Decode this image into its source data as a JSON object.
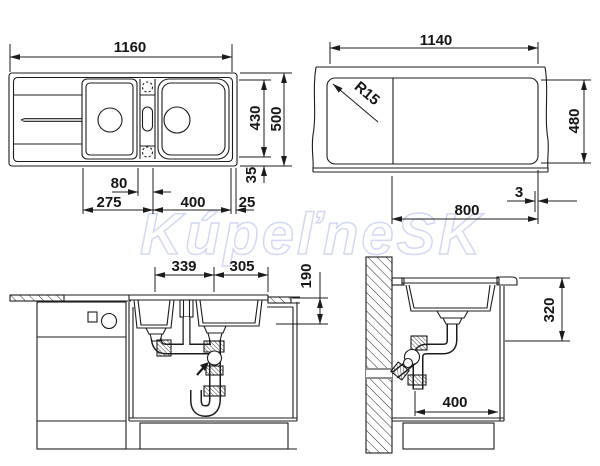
{
  "watermark": {
    "text": "KúpeľneSK"
  },
  "colors": {
    "line": "#1c1c1c",
    "watermark_stroke": "#c8cef2",
    "background": "#ffffff"
  },
  "dims": {
    "plan": {
      "width": "1160",
      "bowl_height": "430",
      "depth": "500",
      "tap_offset": "80",
      "drainboard": "275",
      "bowls_span": "400",
      "edge": "25",
      "rim": "35"
    },
    "cutout": {
      "width": "1140",
      "corner_radius": "R15",
      "height": "480",
      "gap": "3",
      "span": "800"
    },
    "front": {
      "left_drain": "339",
      "right_drain": "305",
      "bowl_depth": "190"
    },
    "side": {
      "clearance_height": "320",
      "clearance_width": "400"
    }
  }
}
